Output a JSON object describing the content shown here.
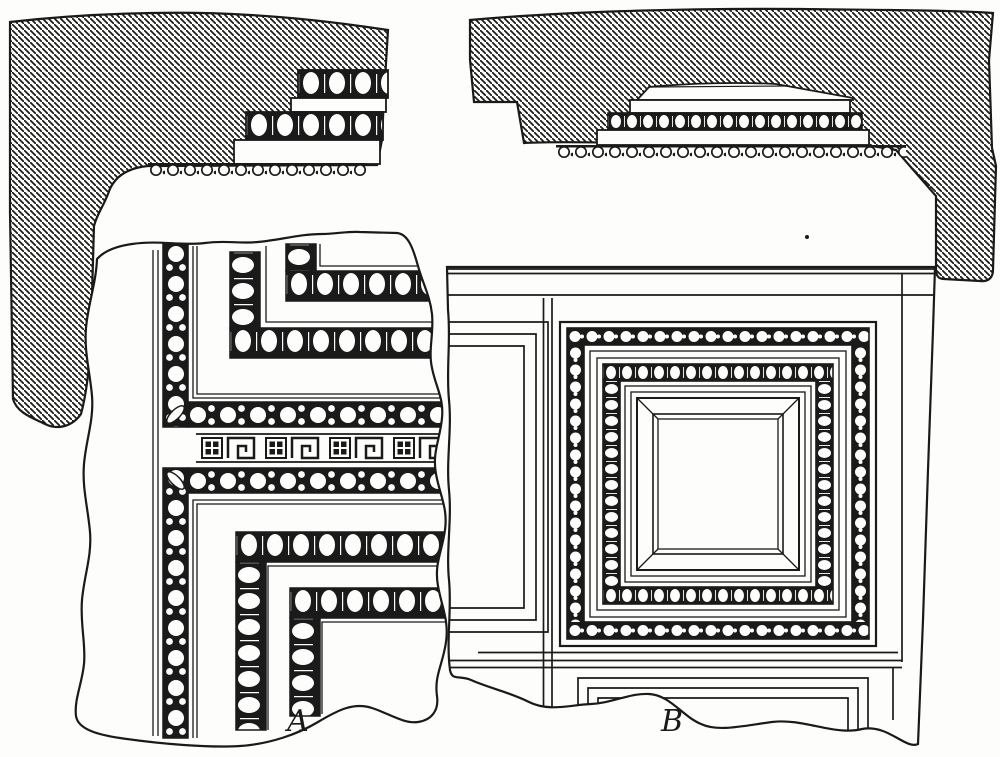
{
  "figure": {
    "labels": {
      "a": "A",
      "b": "B"
    }
  },
  "colors": {
    "ink": "#1a1a1a",
    "paper": "#fdfdfb"
  }
}
